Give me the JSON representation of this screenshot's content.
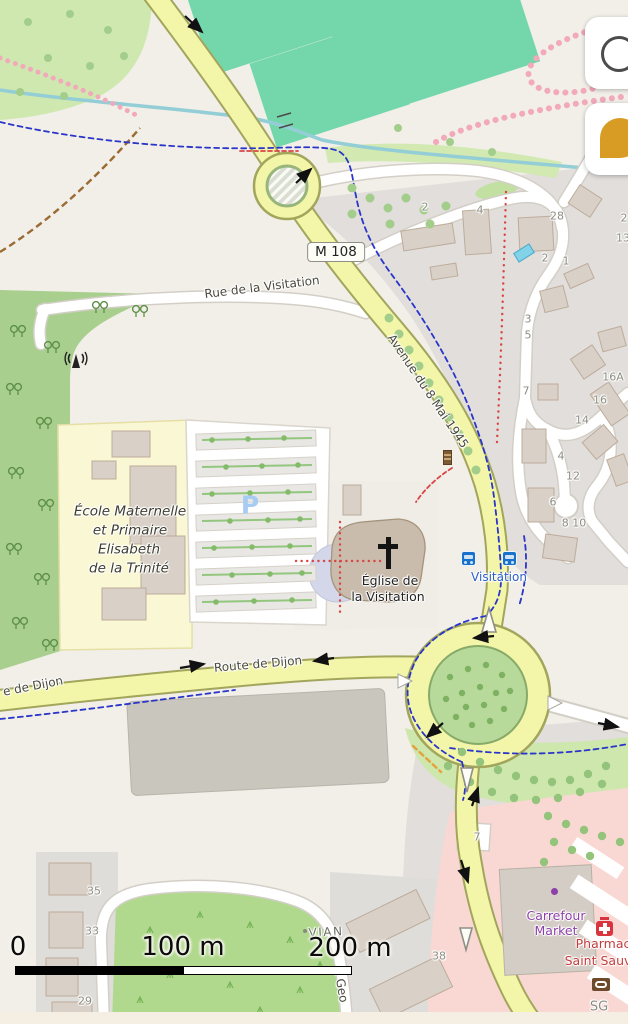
{
  "map": {
    "route_badge": "M 108",
    "labels": [
      {
        "t": "Rue de la Visitation",
        "x": 262,
        "y": 287,
        "r": -7,
        "c": "street",
        "n": "street-label-rue-de-la-visitation"
      },
      {
        "t": "Avenue du 8 Mai 1945",
        "x": 428,
        "y": 391,
        "r": 56,
        "c": "street",
        "n": "street-label-avenue-du-8-mai-1945"
      },
      {
        "t": "Route de Dijon",
        "x": 258,
        "y": 664,
        "r": -5,
        "c": "street",
        "n": "street-label-route-de-dijon"
      },
      {
        "t": "e de Dijon",
        "x": 33,
        "y": 686,
        "r": -11,
        "c": "street",
        "n": "street-label-route-de-dijon-west"
      },
      {
        "t": "e Geo",
        "x": 341,
        "y": 985,
        "r": 80,
        "c": "street",
        "n": "street-label-rue-geo"
      },
      {
        "t": "VIAN",
        "x": 326,
        "y": 932,
        "r": -3,
        "c": "hamlet",
        "n": "hamlet-label-vian"
      },
      {
        "t": "École Maternelle",
        "x": 130,
        "y": 512,
        "c": "school",
        "n": "school-name-line-1"
      },
      {
        "t": "et Primaire",
        "x": 130,
        "y": 531,
        "c": "school",
        "n": "school-name-line-2"
      },
      {
        "t": "Elisabeth",
        "x": 129,
        "y": 550,
        "c": "school",
        "n": "school-name-line-3"
      },
      {
        "t": "de la Trinité",
        "x": 129,
        "y": 569,
        "c": "school",
        "n": "school-name-line-4"
      },
      {
        "t": "Église de",
        "x": 390,
        "y": 581,
        "c": "poi",
        "n": "church-label-line-1"
      },
      {
        "t": "la Visitation",
        "x": 388,
        "y": 597,
        "c": "poi",
        "n": "church-label-line-2"
      },
      {
        "t": "Visitation",
        "x": 499,
        "y": 577,
        "c": "busstop",
        "n": "bus-stop-label"
      },
      {
        "t": "Carrefour",
        "x": 556,
        "y": 916,
        "c": "shop",
        "n": "supermarket-label-line-1"
      },
      {
        "t": "Market",
        "x": 556,
        "y": 931,
        "c": "shop",
        "n": "supermarket-label-line-2"
      },
      {
        "t": "Pharmac",
        "x": 603,
        "y": 944,
        "c": "pharm",
        "n": "pharmacy-label-line-1"
      },
      {
        "t": "Saint Sauv",
        "x": 598,
        "y": 961,
        "c": "pharm",
        "n": "pharmacy-label-line-2"
      },
      {
        "t": "SG",
        "x": 599,
        "y": 1007,
        "c": "grayname",
        "n": "bank-label-sg"
      },
      {
        "t": "P",
        "x": 250,
        "y": 505,
        "c": "parkingP",
        "n": "parking-label"
      },
      {
        "t": "2",
        "x": 425,
        "y": 207,
        "c": "num",
        "n": "house-number"
      },
      {
        "t": "4",
        "x": 480,
        "y": 210,
        "c": "num",
        "n": "house-number"
      },
      {
        "t": "28",
        "x": 557,
        "y": 216,
        "c": "num",
        "n": "house-number"
      },
      {
        "t": "2",
        "x": 624,
        "y": 218,
        "c": "num",
        "n": "house-number"
      },
      {
        "t": "13",
        "x": 623,
        "y": 238,
        "c": "num",
        "n": "house-number"
      },
      {
        "t": "2",
        "x": 545,
        "y": 258,
        "c": "num",
        "n": "house-number"
      },
      {
        "t": "1",
        "x": 566,
        "y": 261,
        "c": "num",
        "n": "house-number"
      },
      {
        "t": "3",
        "x": 528,
        "y": 319,
        "c": "num",
        "n": "house-number"
      },
      {
        "t": "5",
        "x": 528,
        "y": 335,
        "c": "num",
        "n": "house-number"
      },
      {
        "t": "7",
        "x": 526,
        "y": 391,
        "c": "num",
        "n": "house-number"
      },
      {
        "t": "16A",
        "x": 613,
        "y": 377,
        "c": "num",
        "n": "house-number"
      },
      {
        "t": "16",
        "x": 600,
        "y": 400,
        "c": "num",
        "n": "house-number"
      },
      {
        "t": "14",
        "x": 582,
        "y": 420,
        "c": "num",
        "n": "house-number"
      },
      {
        "t": "4",
        "x": 561,
        "y": 456,
        "c": "num",
        "n": "house-number"
      },
      {
        "t": "12",
        "x": 573,
        "y": 476,
        "c": "num",
        "n": "house-number"
      },
      {
        "t": "6",
        "x": 553,
        "y": 502,
        "c": "num",
        "n": "house-number"
      },
      {
        "t": "8 10",
        "x": 574,
        "y": 523,
        "c": "num",
        "n": "house-number"
      },
      {
        "t": "7",
        "x": 477,
        "y": 837,
        "c": "num",
        "n": "road-ref-stub"
      },
      {
        "t": "35",
        "x": 94,
        "y": 891,
        "c": "num",
        "n": "house-number"
      },
      {
        "t": "33",
        "x": 92,
        "y": 931,
        "c": "num",
        "n": "house-number"
      },
      {
        "t": "29",
        "x": 85,
        "y": 1001,
        "c": "num",
        "n": "house-number"
      },
      {
        "t": "38",
        "x": 439,
        "y": 956,
        "c": "num",
        "n": "house-number"
      },
      {
        "t": "0",
        "x": 18,
        "y": 947,
        "c": "scale",
        "n": "scale-label-0"
      },
      {
        "t": "100 m",
        "x": 183,
        "y": 947,
        "c": "scale",
        "n": "scale-label-100m"
      },
      {
        "t": "200 m",
        "x": 350,
        "y": 948,
        "c": "scale",
        "n": "scale-label-200m"
      }
    ],
    "icons": [
      "church-cross-icon",
      "bus-stop-icon",
      "pharmacy-icon",
      "sg-bank-icon",
      "antenna-icon",
      "advertising-column-icon",
      "poi-purple-dot",
      "swimming-pool"
    ],
    "colors": {
      "road_yellow": "#f3f6a8",
      "road_casing": "#a2a55c",
      "cycleway_blue": "#2a35c9",
      "path_red": "#d94545",
      "pitch_teal": "#74d7ab",
      "forest_green": "#a8cf8e",
      "retail_pink": "#f9d8d3",
      "bus_blue": "#1a71c9",
      "shop_purple": "#8d41a8",
      "pharm_red": "#c43c3c"
    }
  },
  "controls": {
    "search_button": {
      "icon": "magnifier-icon"
    },
    "bookmark_button": {
      "icon": "gold-pin-icon"
    }
  },
  "scale_bar": {
    "start": "0",
    "mid": "100 m",
    "end": "200 m"
  }
}
